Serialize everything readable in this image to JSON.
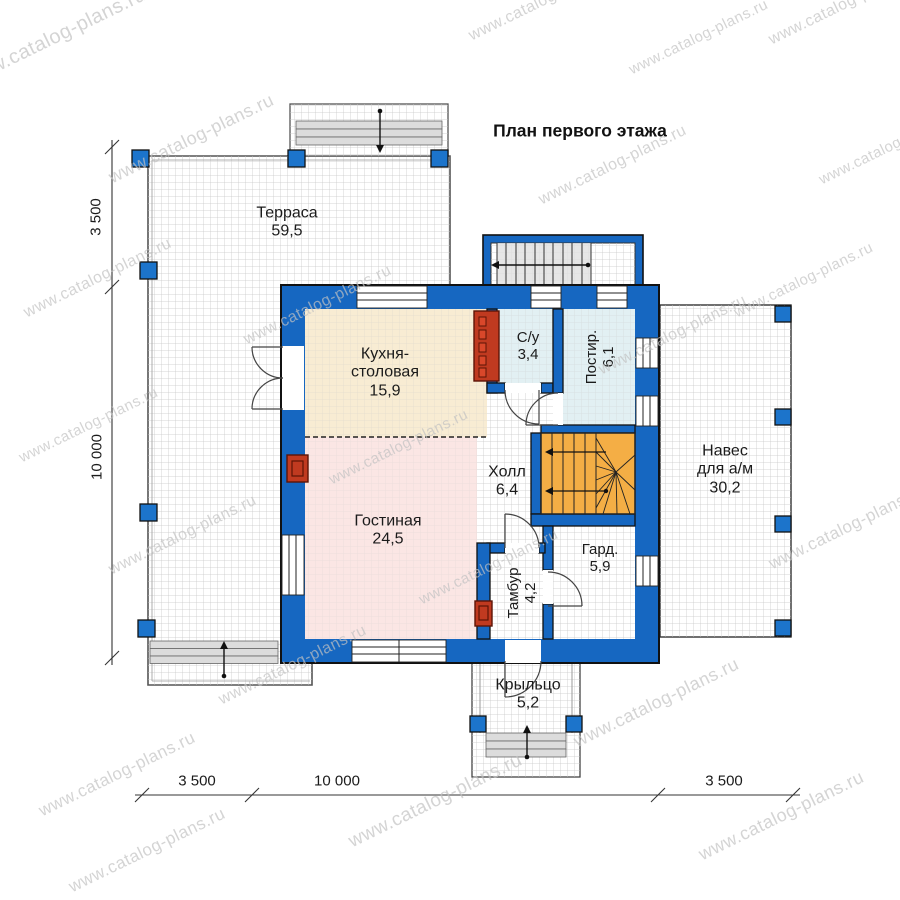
{
  "title": "План первого этажа",
  "watermark": {
    "text": "www.catalog-plans.ru"
  },
  "rooms": {
    "terrace": {
      "name": "Терраса",
      "area": "59,5"
    },
    "kitchen": {
      "name": "Кухня-столовая",
      "area": "15,9"
    },
    "bathroom": {
      "name": "С/у",
      "area": "3,4"
    },
    "laundry": {
      "name": "Постир.",
      "area": "6,1"
    },
    "hall": {
      "name": "Холл",
      "area": "6,4"
    },
    "living": {
      "name": "Гостиная",
      "area": "24,5"
    },
    "vestibule": {
      "name": "Тамбур",
      "area": "4,2"
    },
    "wardrobe": {
      "name": "Гард.",
      "area": "5,9"
    },
    "carport": {
      "name": "Навес для а/м",
      "area": "30,2"
    },
    "porch": {
      "name": "Крыльцо",
      "area": "5,2"
    }
  },
  "dimensions": {
    "left": [
      "3 500",
      "10 000"
    ],
    "bottom": [
      "3 500",
      "10 000",
      "3 500"
    ]
  },
  "colors": {
    "wall": "#1667c1",
    "kitchen": "#f8ecd3",
    "living": "#fbe6e4",
    "wet": "#e2f0f3",
    "stairs": "#f4ae45",
    "flue": "#c03a20",
    "post": "#1c74cb",
    "grid": "#c9c9c9",
    "watermark": "#c2c2c2"
  }
}
